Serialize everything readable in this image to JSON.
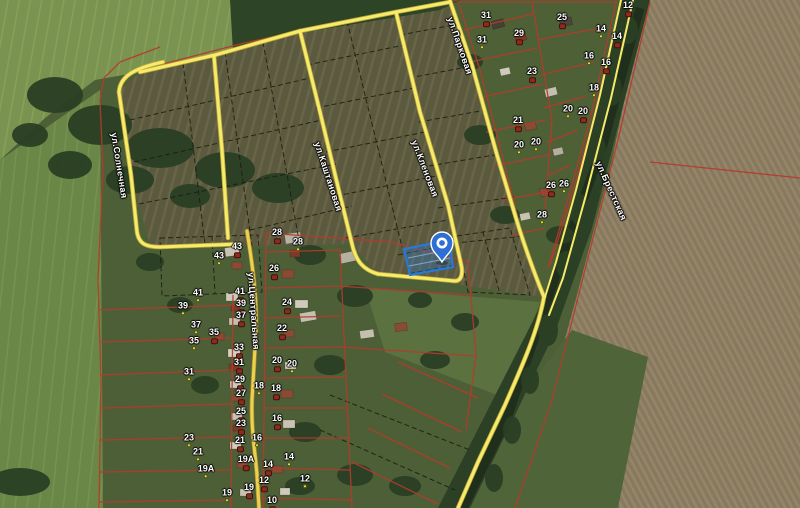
{
  "map": {
    "streets": [
      {
        "name": "ул.Солнечная",
        "x": 118,
        "y": 132,
        "angle": 81
      },
      {
        "name": "ул.Каштановая",
        "x": 321,
        "y": 141,
        "angle": 72
      },
      {
        "name": "ул.Кленовая",
        "x": 418,
        "y": 139,
        "angle": 69
      },
      {
        "name": "ул.Парковая",
        "x": 454,
        "y": 16,
        "angle": 71
      },
      {
        "name": "ул.Брестская",
        "x": 602,
        "y": 160,
        "angle": 66
      },
      {
        "name": "ул.Центральная",
        "x": 255,
        "y": 272,
        "angle": 86
      }
    ],
    "parcels": [
      {
        "n": "31",
        "x": 486,
        "y": 20,
        "m": "b"
      },
      {
        "n": "31",
        "x": 482,
        "y": 43,
        "m": "d"
      },
      {
        "n": "29",
        "x": 519,
        "y": 38,
        "m": "b"
      },
      {
        "n": "25",
        "x": 562,
        "y": 22,
        "m": "b"
      },
      {
        "n": "12",
        "x": 628,
        "y": 10,
        "m": "b"
      },
      {
        "n": "14",
        "x": 601,
        "y": 32,
        "m": "d"
      },
      {
        "n": "14",
        "x": 617,
        "y": 41,
        "m": "b"
      },
      {
        "n": "23",
        "x": 532,
        "y": 76,
        "m": "b"
      },
      {
        "n": "16",
        "x": 589,
        "y": 59,
        "m": "d"
      },
      {
        "n": "16",
        "x": 606,
        "y": 67,
        "m": "b"
      },
      {
        "n": "18",
        "x": 594,
        "y": 91,
        "m": "d"
      },
      {
        "n": "20",
        "x": 568,
        "y": 112,
        "m": "d"
      },
      {
        "n": "20",
        "x": 583,
        "y": 116,
        "m": "b"
      },
      {
        "n": "21",
        "x": 518,
        "y": 125,
        "m": "b"
      },
      {
        "n": "20",
        "x": 536,
        "y": 145,
        "m": "d"
      },
      {
        "n": "20",
        "x": 519,
        "y": 148,
        "m": "d"
      },
      {
        "n": "26",
        "x": 551,
        "y": 190,
        "m": "b"
      },
      {
        "n": "26",
        "x": 564,
        "y": 187,
        "m": "d"
      },
      {
        "n": "28",
        "x": 542,
        "y": 218,
        "m": "d"
      },
      {
        "n": "28",
        "x": 277,
        "y": 237,
        "m": "b"
      },
      {
        "n": "28",
        "x": 298,
        "y": 245,
        "m": "d"
      },
      {
        "n": "43",
        "x": 237,
        "y": 251,
        "m": "b"
      },
      {
        "n": "43",
        "x": 219,
        "y": 259,
        "m": "d"
      },
      {
        "n": "26",
        "x": 274,
        "y": 273,
        "m": "b"
      },
      {
        "n": "41",
        "x": 240,
        "y": 296,
        "m": "b"
      },
      {
        "n": "41",
        "x": 198,
        "y": 296,
        "m": "d"
      },
      {
        "n": "24",
        "x": 287,
        "y": 307,
        "m": "b"
      },
      {
        "n": "39",
        "x": 241,
        "y": 308,
        "m": "b"
      },
      {
        "n": "39",
        "x": 183,
        "y": 309,
        "m": "d"
      },
      {
        "n": "37",
        "x": 241,
        "y": 320,
        "m": "b"
      },
      {
        "n": "37",
        "x": 196,
        "y": 328,
        "m": "d"
      },
      {
        "n": "22",
        "x": 282,
        "y": 333,
        "m": "b"
      },
      {
        "n": "35",
        "x": 214,
        "y": 337,
        "m": "b"
      },
      {
        "n": "35",
        "x": 194,
        "y": 344,
        "m": "d"
      },
      {
        "n": "33",
        "x": 239,
        "y": 352,
        "m": "b"
      },
      {
        "n": "20",
        "x": 277,
        "y": 365,
        "m": "b"
      },
      {
        "n": "20",
        "x": 292,
        "y": 367,
        "m": "d"
      },
      {
        "n": "31",
        "x": 239,
        "y": 367,
        "m": "b"
      },
      {
        "n": "31",
        "x": 189,
        "y": 375,
        "m": "d"
      },
      {
        "n": "29",
        "x": 240,
        "y": 384,
        "m": "b"
      },
      {
        "n": "18",
        "x": 259,
        "y": 389,
        "m": "d"
      },
      {
        "n": "18",
        "x": 276,
        "y": 393,
        "m": "b"
      },
      {
        "n": "27",
        "x": 241,
        "y": 398,
        "m": "b"
      },
      {
        "n": "25",
        "x": 241,
        "y": 416,
        "m": "b"
      },
      {
        "n": "16",
        "x": 277,
        "y": 423,
        "m": "b"
      },
      {
        "n": "23",
        "x": 241,
        "y": 428,
        "m": "b"
      },
      {
        "n": "23",
        "x": 189,
        "y": 441,
        "m": "d"
      },
      {
        "n": "16",
        "x": 257,
        "y": 441,
        "m": "d"
      },
      {
        "n": "21",
        "x": 240,
        "y": 445,
        "m": "b"
      },
      {
        "n": "21",
        "x": 198,
        "y": 455,
        "m": "d"
      },
      {
        "n": "14",
        "x": 289,
        "y": 460,
        "m": "d"
      },
      {
        "n": "19А",
        "x": 246,
        "y": 464,
        "m": "b"
      },
      {
        "n": "14",
        "x": 268,
        "y": 469,
        "m": "b"
      },
      {
        "n": "19А",
        "x": 206,
        "y": 472,
        "m": "d"
      },
      {
        "n": "12",
        "x": 305,
        "y": 482,
        "m": "d"
      },
      {
        "n": "12",
        "x": 264,
        "y": 485,
        "m": "b"
      },
      {
        "n": "19",
        "x": 249,
        "y": 492,
        "m": "b"
      },
      {
        "n": "19",
        "x": 227,
        "y": 496,
        "m": "d"
      },
      {
        "n": "10",
        "x": 272,
        "y": 505,
        "m": "b"
      }
    ],
    "selected_parcel": {
      "points": "404,249 449,240 453,267 410,275"
    },
    "marker": {
      "x": 442,
      "y": 262
    },
    "colors": {
      "road": "#f7eb69",
      "road_casing": "#b9a63e",
      "central_road": "#ecd14f",
      "cadastral_line": "#b43b2c",
      "field_boundary": "#1a1a10",
      "selection_fill": "rgba(37,121,216,0.32)",
      "selection_stroke": "#2579d8",
      "marker": "#2e6fd6",
      "marker_ring": "#ffffff"
    }
  }
}
